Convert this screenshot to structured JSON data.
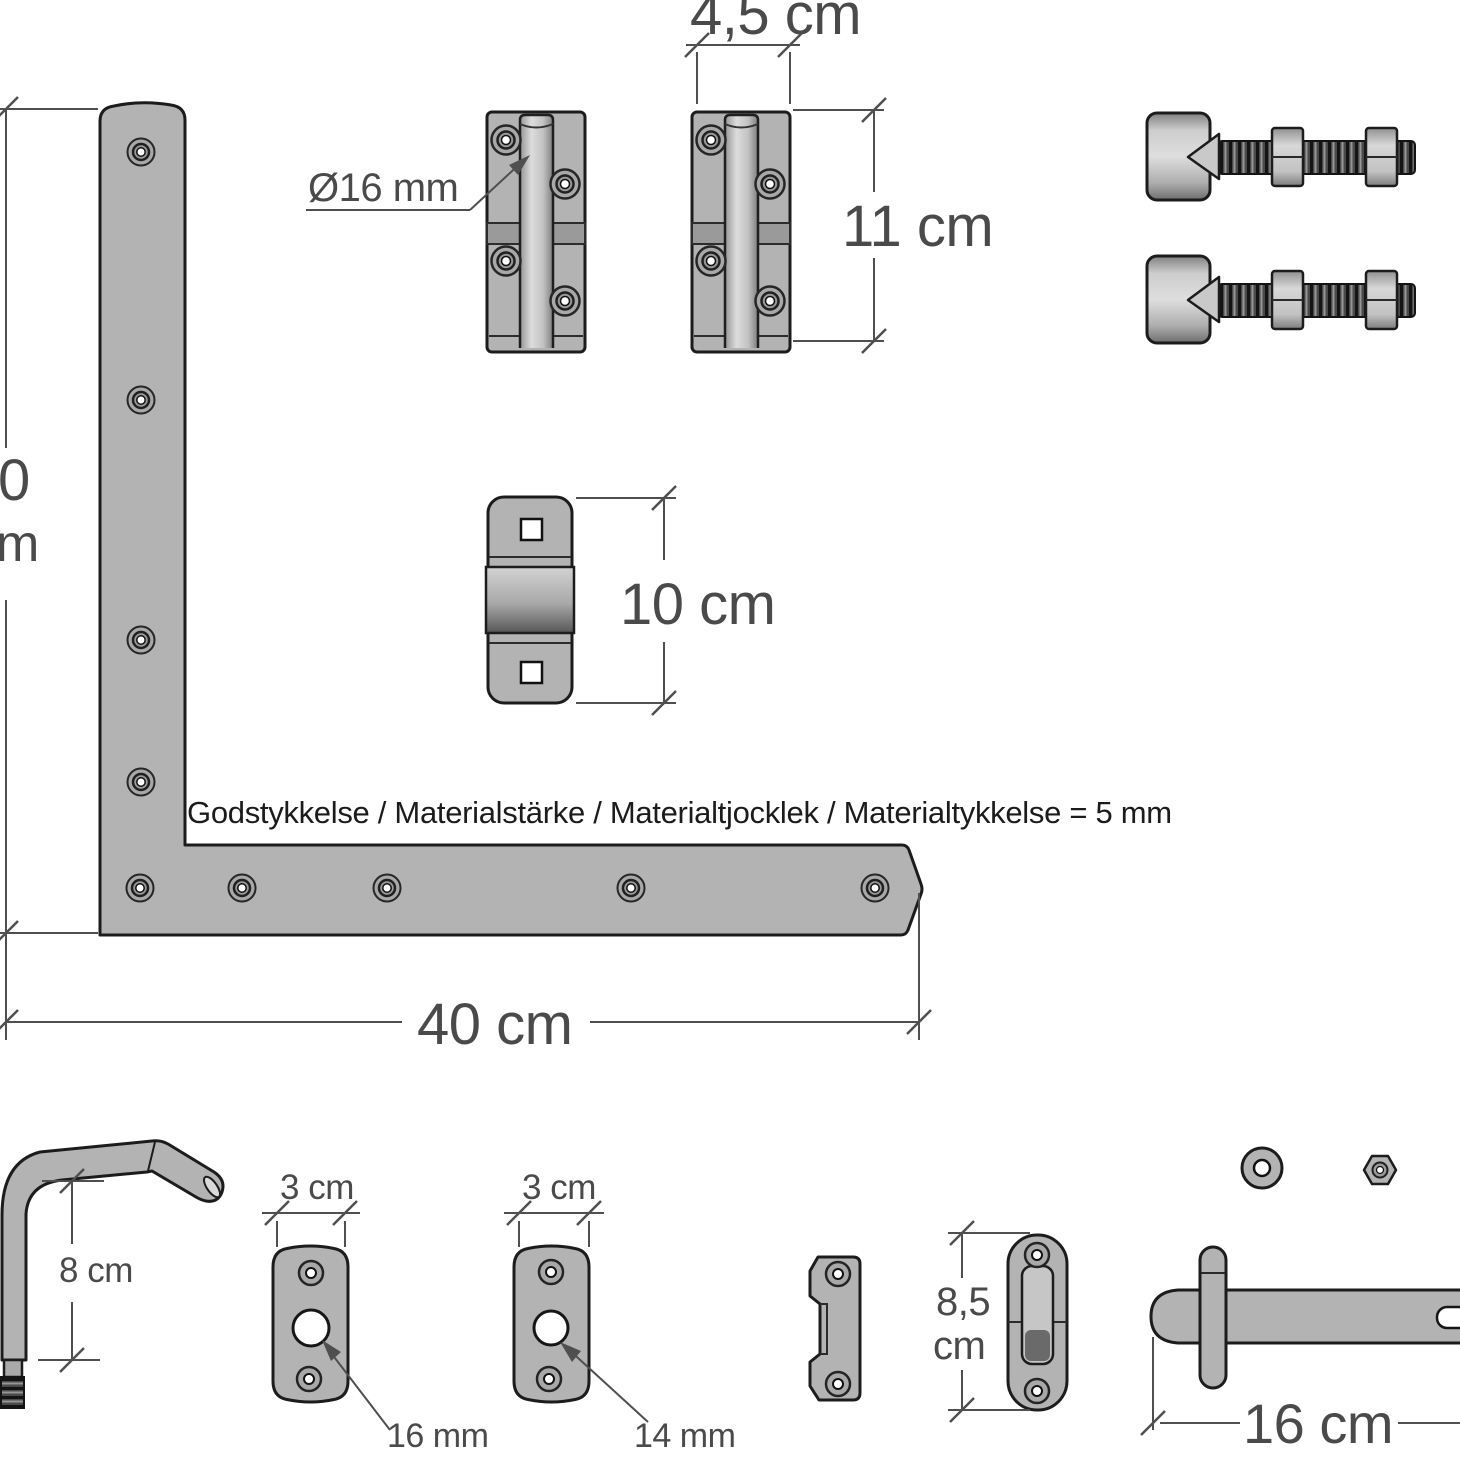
{
  "colors": {
    "background": "#ffffff",
    "metal": "#b3b3b3",
    "outline": "#1c1c1c",
    "dimension": "#4f4f4f"
  },
  "labels": {
    "hinge_block_width": "4,5 cm",
    "hinge_block_height": "11 cm",
    "pin_diameter": "Ø16 mm",
    "strap_height_clipped_value": "0",
    "strap_height_clipped_unit": "m",
    "keeper_height": "10 cm",
    "material_note": "Godstykkelse / Materialstärke / Materialtjocklek / Materialtykkelse = 5 mm",
    "strap_length": "40 cm",
    "pin_leg_height": "8 cm",
    "plate_16_width": "3 cm",
    "plate_16_hole": "16 mm",
    "plate_14_width": "3 cm",
    "plate_14_hole": "14 mm",
    "latch_keeper_height_value": "8,5",
    "latch_keeper_height_unit": "cm",
    "drop_bolt_length": "16 cm"
  }
}
